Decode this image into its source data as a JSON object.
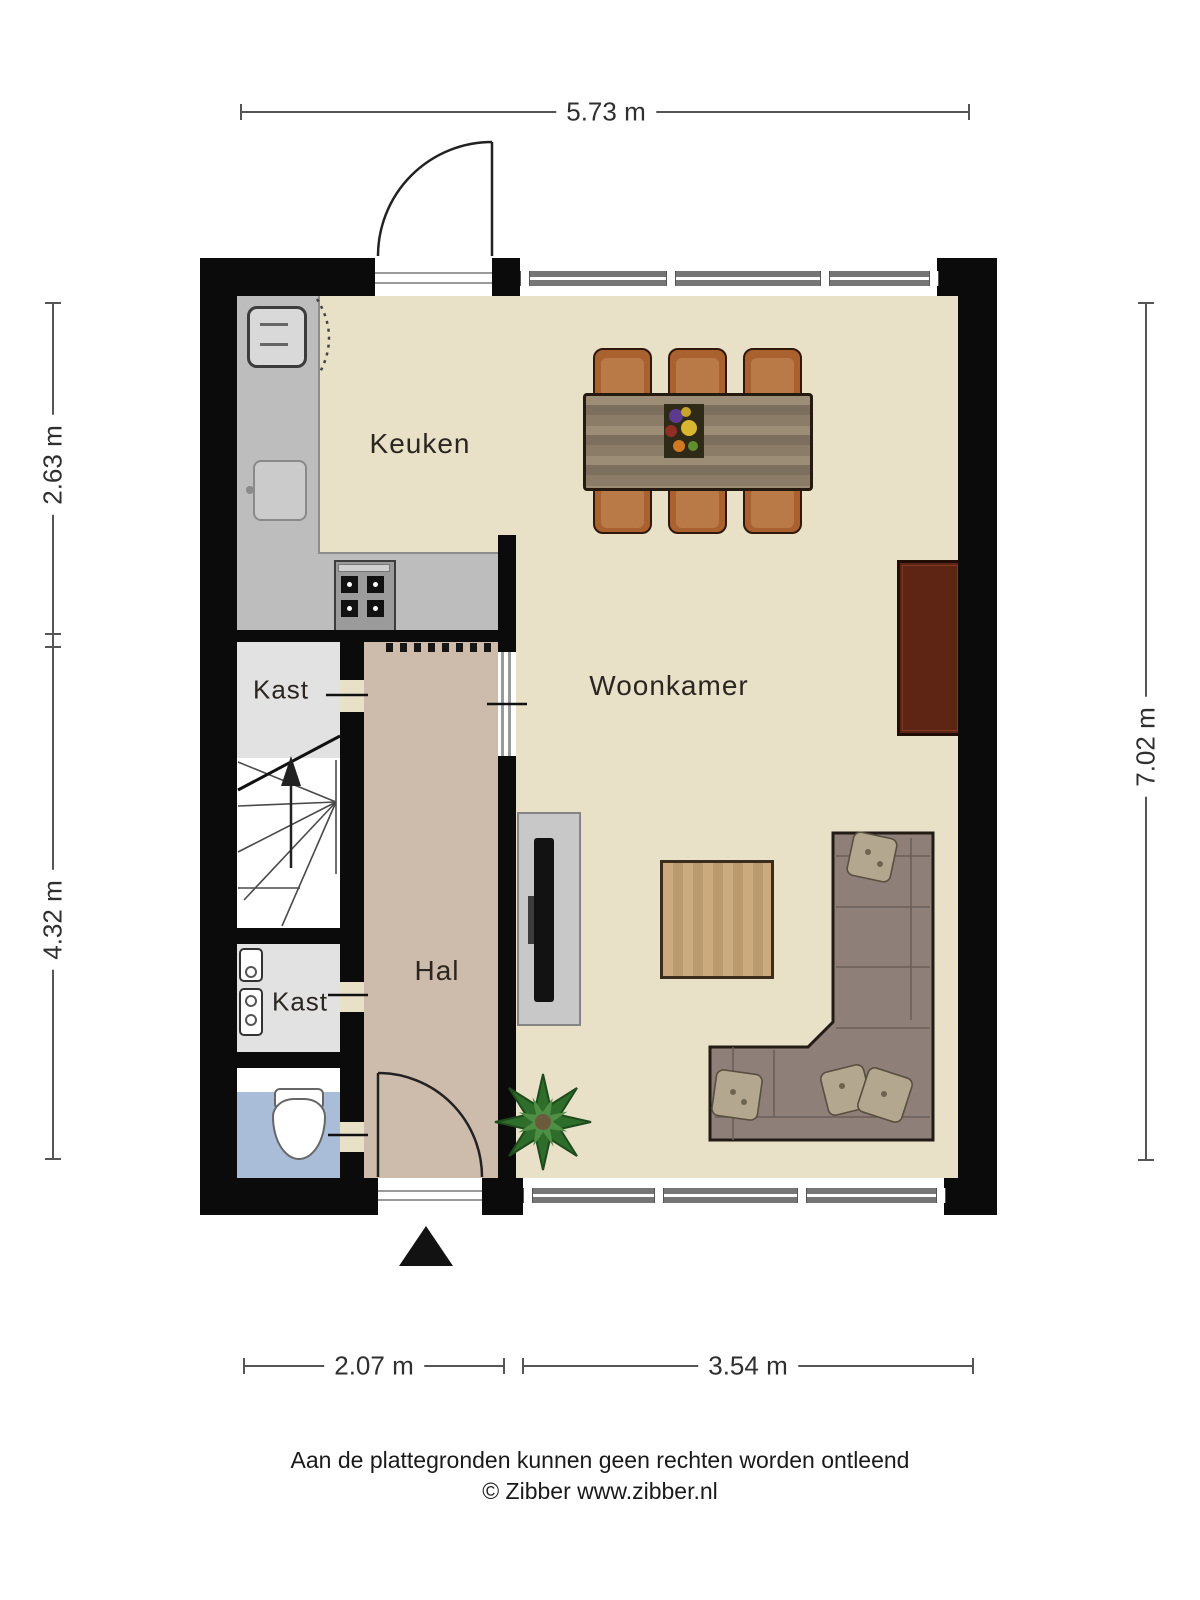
{
  "rooms": {
    "kitchen": "Keuken",
    "living": "Woonkamer",
    "hall": "Hal",
    "closet_upper": "Kast",
    "closet_lower": "Kast"
  },
  "dimensions": {
    "top": "5.73 m",
    "left_upper": "2.63 m",
    "left_lower": "4.32 m",
    "right": "7.02 m",
    "bottom_left": "2.07 m",
    "bottom_right": "3.54 m"
  },
  "footer": {
    "line1": "Aan de plattegronden kunnen geen rechten worden ontleend",
    "line2": "© Zibber www.zibber.nl"
  },
  "colors": {
    "wall": "#0b0b0b",
    "floor": "#e8e1c8",
    "hallfloor": "#cdbcab",
    "closet": "#e2e2e2",
    "toiletfloor": "#a9bdd9",
    "counter": "#bdbdbd",
    "glass": "#767676",
    "dim": "#555555",
    "dim-ink": "#2f2f2f",
    "ink": "#2b2620",
    "chair": "#a9612f",
    "tablewood": "#8b7c68",
    "sideboard": "#5e2514",
    "coffee": "#c4a277",
    "tvpanel": "#c8c8c8",
    "sofa": "#8e7f79",
    "stove": "#9b9b9b"
  }
}
